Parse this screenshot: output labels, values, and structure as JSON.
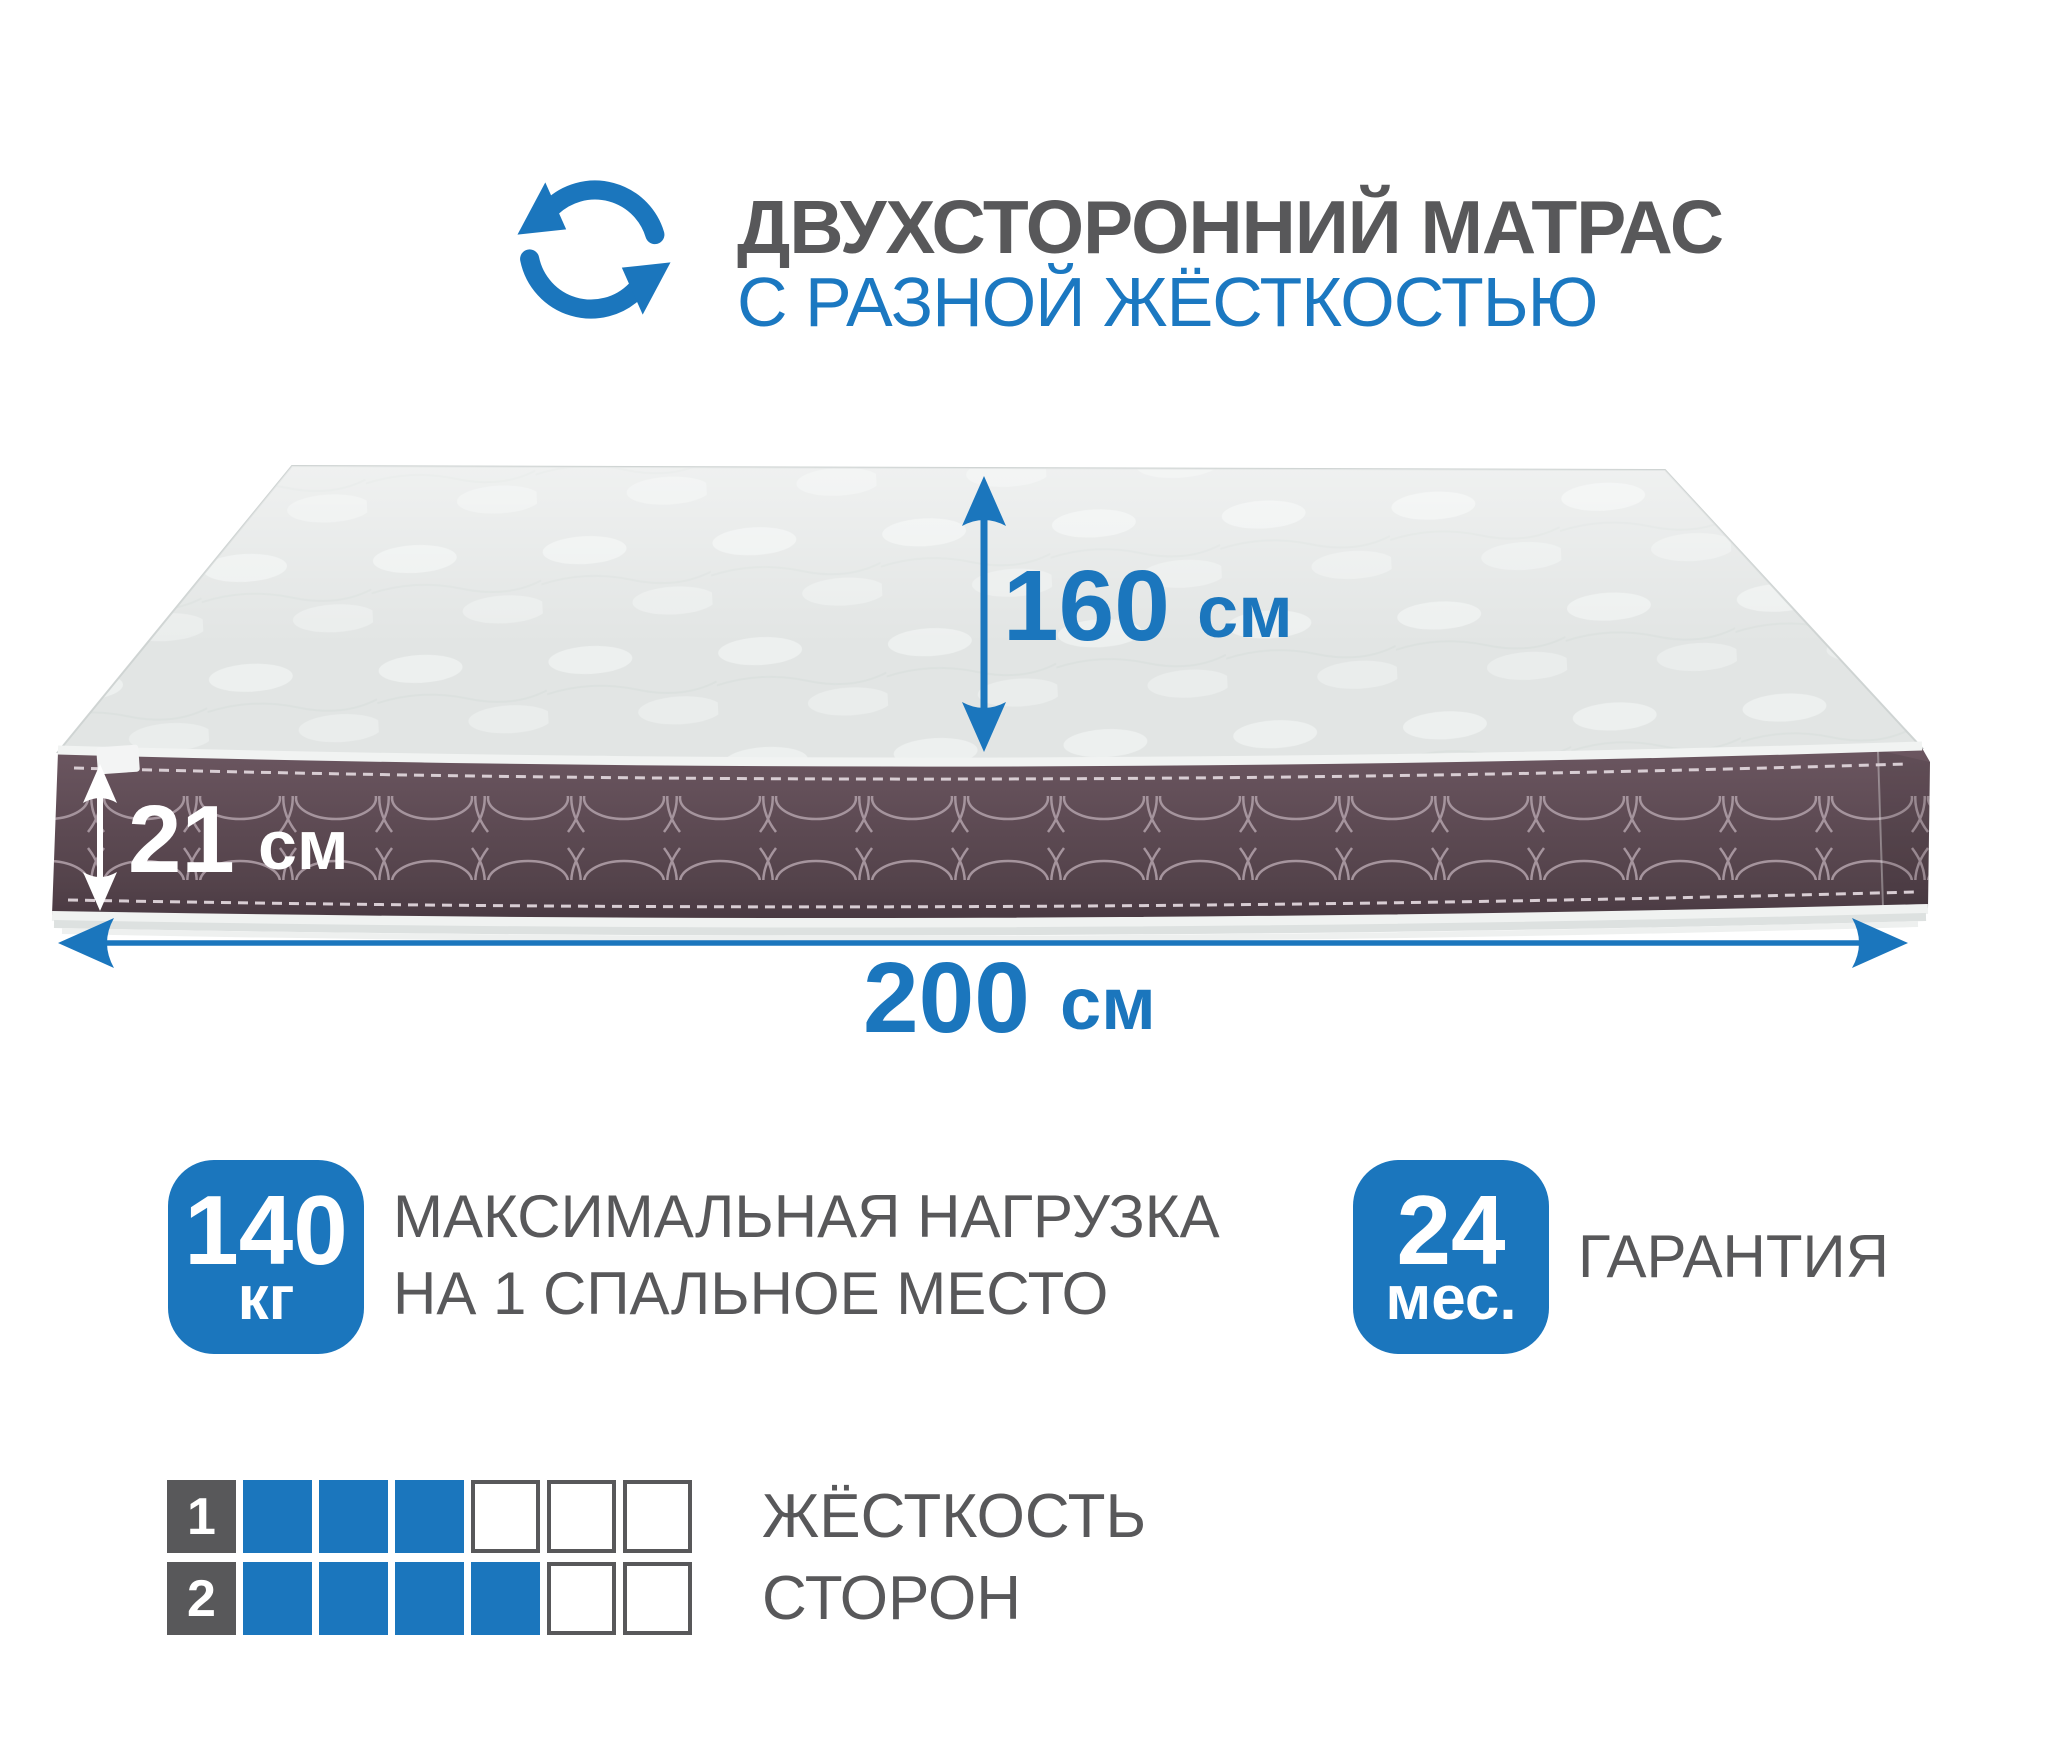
{
  "accent_color": "#1b76bd",
  "text_gray_color": "#58585a",
  "header": {
    "icon": "rotate-arrows-icon",
    "title": "ДВУХСТОРОННИЙ МАТРАС",
    "subtitle": "С РАЗНОЙ ЖЁСТКОСТЬЮ"
  },
  "mattress": {
    "top_color": "#e2e5e4",
    "side_color": "#5d4a53",
    "width_label": {
      "value": "160",
      "unit": "см"
    },
    "height_label": {
      "value": "21",
      "unit": "см"
    },
    "length_label": {
      "value": "200",
      "unit": "см"
    }
  },
  "features": {
    "max_load": {
      "badge_value": "140",
      "badge_unit": "кг",
      "label_line1": "МАКСИМАЛЬНАЯ НАГРУЗКА",
      "label_line2": "НА 1 СПАЛЬНОЕ МЕСТО"
    },
    "warranty": {
      "badge_value": "24",
      "badge_unit": "мес.",
      "label": "ГАРАНТИЯ"
    }
  },
  "firmness": {
    "label_line1": "ЖЁСТКОСТЬ",
    "label_line2": "СТОРОН",
    "scale_max": 6,
    "rows": [
      {
        "label": "1",
        "filled": 3
      },
      {
        "label": "2",
        "filled": 4
      }
    ]
  }
}
